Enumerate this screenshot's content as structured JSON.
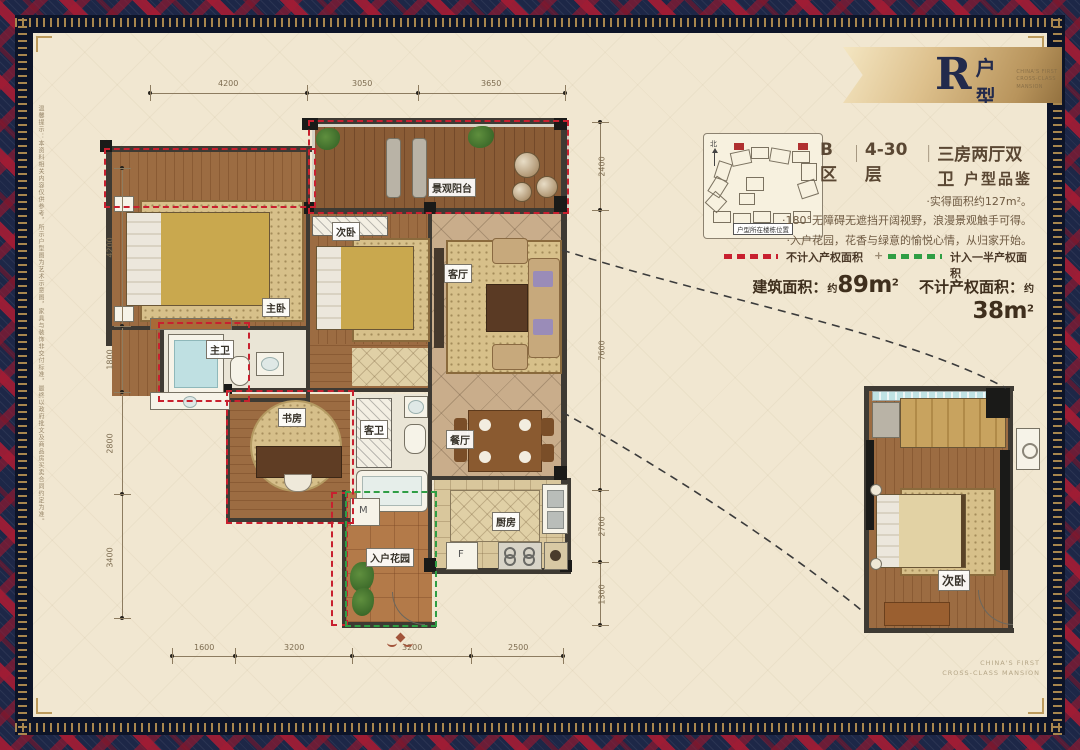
{
  "banner": {
    "letter": "R",
    "suffix": "户型",
    "tag1": "CHINA'S FIRST",
    "tag2": "CROSS-CLASS MANSION"
  },
  "info": {
    "zone": "B区",
    "sep1": "｜",
    "floors": "4-30层",
    "sep2": "｜",
    "layout": "三房两厅双卫",
    "subtitle": "户型品鉴",
    "bullets": [
      "·实得面积约127m²。",
      "·180°无障碍无遮挡开阔视野，浪漫景观触手可得。",
      "·入户花园，花香与绿意的愉悦心情，从归家开始。"
    ]
  },
  "legend": {
    "red_label": "不计入产权面积",
    "plus": "+",
    "green_label": "计入一半产权面积",
    "red_color": "#c8202f",
    "green_color": "#2f9e44"
  },
  "areas": {
    "built_label": "建筑面积：",
    "built_prefix": "约",
    "built_value": "89m",
    "built_sup": "2",
    "excl_label": "不计产权面积：",
    "excl_prefix": "约",
    "excl_value": "38m",
    "excl_sup": "2"
  },
  "site": {
    "caption": "户型所在楼栋位置",
    "north": "北"
  },
  "plan": {
    "rooms": [
      "主卧",
      "次卧",
      "景观阳台",
      "客厅",
      "餐厅",
      "主卫",
      "书房",
      "客卫",
      "厨房",
      "入户花园"
    ],
    "appliances": {
      "washer": "M",
      "fridge": "F"
    },
    "dims_top": [
      "4200",
      "3050",
      "3650"
    ],
    "dims_left": [
      "4200",
      "1800",
      "2800",
      "3400"
    ],
    "dims_right": [
      "2400",
      "7600",
      "2700",
      "1300"
    ],
    "dims_bottom": [
      "1600",
      "3200",
      "3200",
      "2500"
    ]
  },
  "detail": {
    "label": "次卧"
  },
  "footer": {
    "line1": "CHINA'S FIRST",
    "line2": "CROSS-CLASS MANSION"
  },
  "disclaimer": "温馨提示：本资料相关内容仅供参考，所示户型图为艺术示意图，家具与装饰非交付标准，最终以政府批文及商品房买卖合同约定为准。"
}
